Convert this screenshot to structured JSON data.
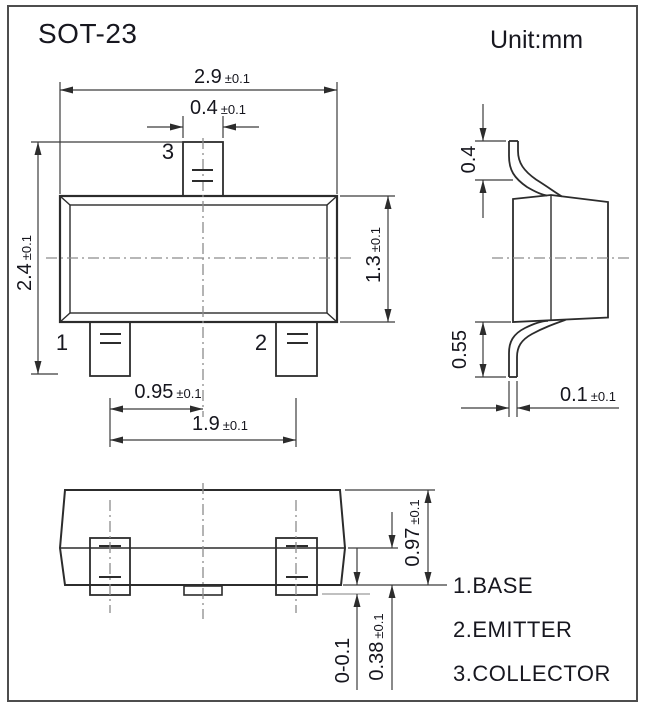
{
  "title": "SOT-23",
  "unit_label": "Unit:mm",
  "legend": [
    "1.BASE",
    "2.EMITTER",
    "3.COLLECTOR"
  ],
  "pins": {
    "pin1": "1",
    "pin2": "2",
    "pin3": "3"
  },
  "dimensions": {
    "top_width": {
      "value": "2.9",
      "tol": "±0.1"
    },
    "lead3_width": {
      "value": "0.4",
      "tol": "±0.1"
    },
    "top_height": {
      "value": "2.4",
      "tol": "±0.1"
    },
    "body_height": {
      "value": "1.3",
      "tol": "±0.1"
    },
    "lead_pitch": {
      "value": "0.95",
      "tol": "±0.1"
    },
    "lead_span": {
      "value": "1.9",
      "tol": "±0.1"
    },
    "side_lead_top": {
      "value": "0.4",
      "tol": ""
    },
    "side_lead_foot": {
      "value": "0.55",
      "tol": ""
    },
    "side_standoff": {
      "value": "0.1",
      "tol": "±0.1"
    },
    "front_height": {
      "value": "0.97",
      "tol": "±0.1"
    },
    "front_lead": {
      "value": "0.38",
      "tol": "±0.1"
    },
    "front_standoff": {
      "value": "0-0.1",
      "tol": ""
    }
  },
  "colors": {
    "line": "#2c2c2c",
    "thin_line": "#3c3c3c",
    "centerline": "#8c8c8c",
    "text": "#15151d",
    "background": "#ffffff",
    "frame": "#4d4d4d"
  }
}
